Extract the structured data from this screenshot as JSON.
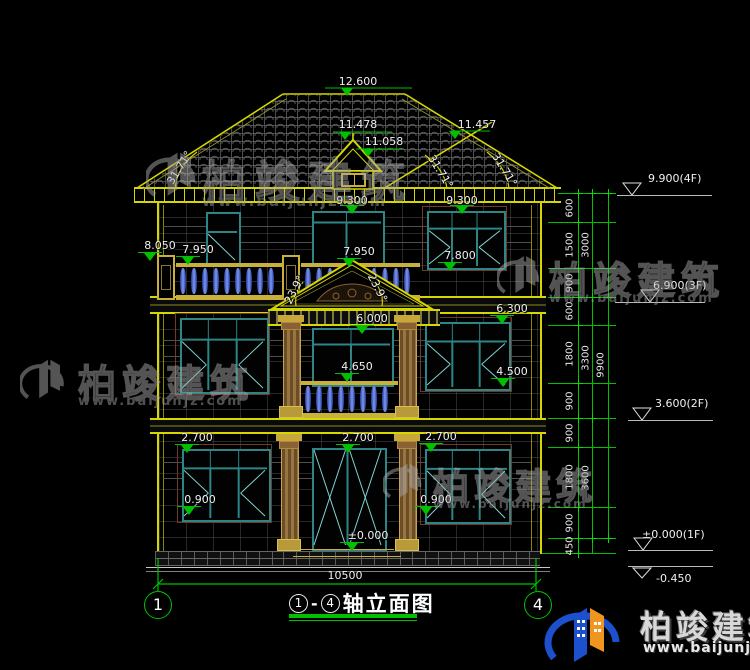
{
  "meta": {
    "title_axis_start": "1",
    "title_axis_end": "4",
    "title_dash": "-",
    "title_text": "轴立面图"
  },
  "axes": [
    {
      "label": "1"
    },
    {
      "label": "4"
    }
  ],
  "bottom_dimension": "10500",
  "dims": [
    {
      "text": "12.600"
    },
    {
      "text": "11.478"
    },
    {
      "text": "11.058"
    },
    {
      "text": "11.457"
    },
    {
      "text": "9.300"
    },
    {
      "text": "9.300"
    },
    {
      "text": "8.050"
    },
    {
      "text": "7.950"
    },
    {
      "text": "7.950"
    },
    {
      "text": "7.800"
    },
    {
      "text": "31.71°"
    },
    {
      "text": "31.71°"
    },
    {
      "text": "31.71°"
    },
    {
      "text": "23.9°"
    },
    {
      "text": "23.9°"
    },
    {
      "text": "6.000"
    },
    {
      "text": "6.300"
    },
    {
      "text": "4.650"
    },
    {
      "text": "4.500"
    },
    {
      "text": "2.700"
    },
    {
      "text": "2.700"
    },
    {
      "text": "2.700"
    },
    {
      "text": "0.900"
    },
    {
      "text": "0.900"
    },
    {
      "text": "±0.000"
    }
  ],
  "levels": [
    {
      "text": "9.900(4F)"
    },
    {
      "text": "6.900(3F)"
    },
    {
      "text": "3.600(2F)"
    },
    {
      "text": "±0.000(1F)"
    },
    {
      "text": "-0.450"
    }
  ],
  "chains": {
    "inner": [
      "600",
      "1500",
      "900",
      "600",
      "1800",
      "900",
      "900",
      "1800",
      "900",
      "450"
    ],
    "middle": [
      "3000",
      "3300",
      "3600"
    ],
    "outer": [
      "9900"
    ]
  },
  "watermark": {
    "brand": "柏竣建筑",
    "url": "www.baijunjz.com"
  },
  "footer": {
    "brand": "柏竣建筑",
    "url": "www.baijunjz.com"
  }
}
